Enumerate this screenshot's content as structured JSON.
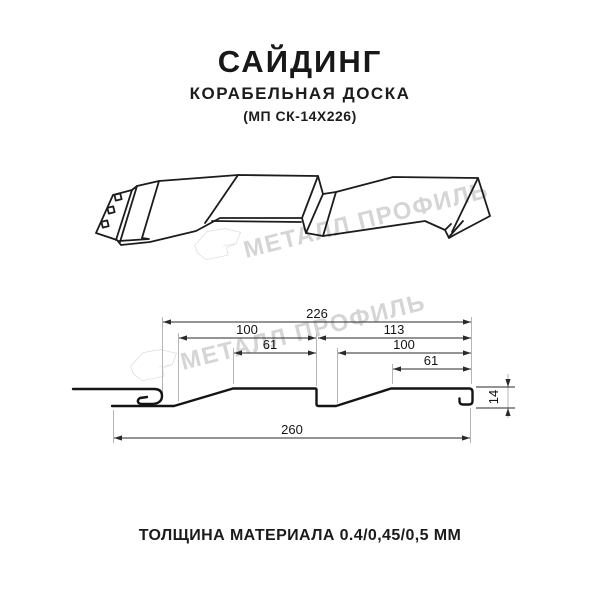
{
  "header": {
    "title": "САЙДИНГ",
    "subtitle": "КОРАБЕЛЬНАЯ ДОСКА",
    "model": "(МП СК-14Х226)"
  },
  "watermark": {
    "brand": "МЕТАЛЛ ПРОФИЛЬ",
    "color": "#d5d5d5"
  },
  "drawing": {
    "type": "technical-drawing",
    "views": [
      "perspective-3d",
      "cross-section"
    ],
    "units": "mm",
    "dimensions": {
      "visible_width": "226",
      "left_panel": "100",
      "right_segment": "113",
      "left_slope": "61",
      "right_panel": "100",
      "right_slope": "61",
      "total_width": "260",
      "height": "14"
    }
  },
  "footer": {
    "thickness_label": "ТОЛЩИНА МАТЕРИАЛА 0.4/0,45/0,5 ММ"
  }
}
